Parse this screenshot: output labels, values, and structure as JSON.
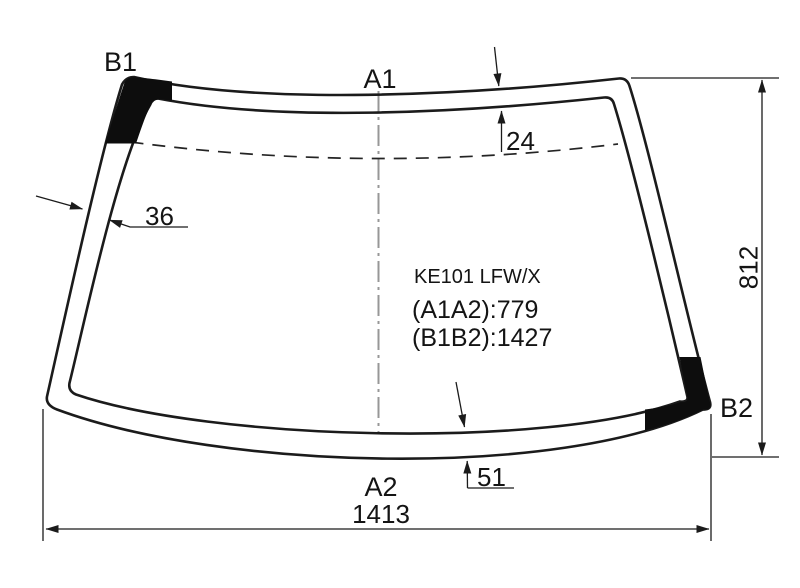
{
  "drawing": {
    "title": "KE101 LFW/X",
    "spec_a1a2": "(A1A2):779",
    "spec_b1b2": "(B1B2):1427",
    "corner_labels": {
      "b1": "B1",
      "a1": "A1",
      "b2": "B2",
      "a2": "A2"
    },
    "dimensions": {
      "top_band_height": "24",
      "left_band_width": "36",
      "bottom_band_height": "51",
      "glass_height": "812",
      "glass_width": "1413"
    },
    "colors": {
      "line": "#1b1b1b",
      "background": "#ffffff",
      "center_axis": "#979797",
      "corner_patch": "#0d0d0d"
    }
  }
}
